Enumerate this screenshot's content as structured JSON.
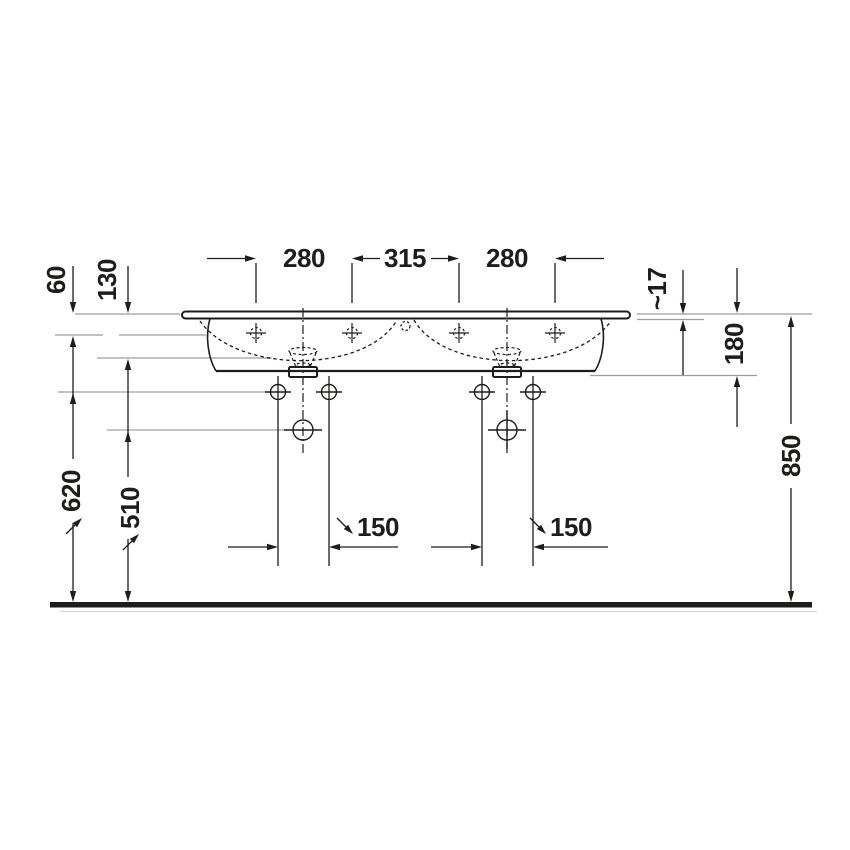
{
  "diagram": {
    "type": "technical-drawing",
    "subject": "double washbasin front elevation with installation dimensions",
    "unit": "mm",
    "labels": {
      "tap_spacing_left": "280",
      "tap_spacing_center": "315",
      "tap_spacing_right": "280",
      "rim_to_tap_axis": "60",
      "rim_to_basin_line": "130",
      "rim_thickness": "~17",
      "body_depth": "180",
      "rim_height_total": "850",
      "fixing_hole_height": "620",
      "drain_height": "510",
      "fixing_hole_spacing_left": "150",
      "fixing_hole_spacing_right": "150"
    },
    "colors": {
      "line_black": "#1d1d1b",
      "extension_gray": "#9d9d9c"
    }
  }
}
